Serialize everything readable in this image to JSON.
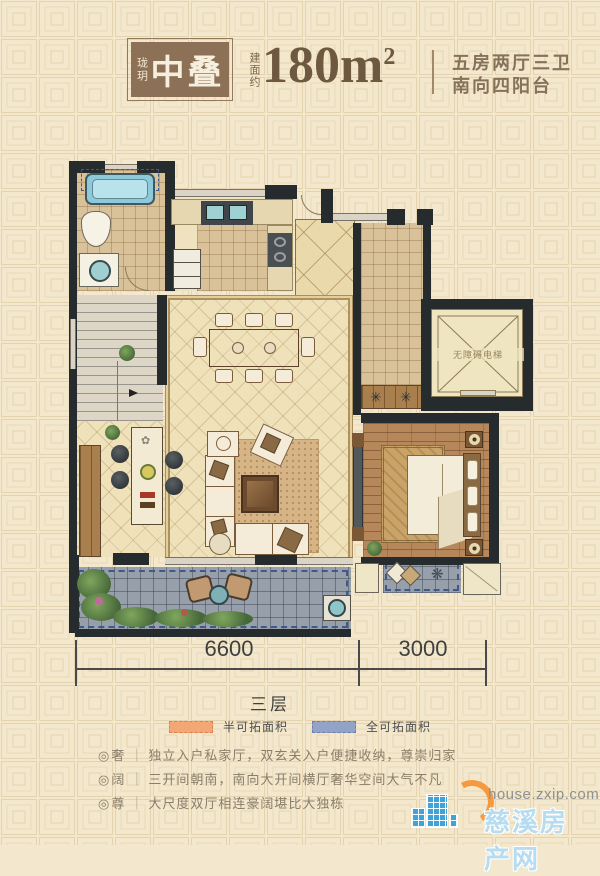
{
  "header": {
    "brand": "珑玥",
    "badge_title": "中叠",
    "area_prefix": "建面约",
    "area_value": "180m",
    "area_sup": "2",
    "spec_line1": "五房两厅三卫",
    "spec_line2": "南向四阳台"
  },
  "plan": {
    "elevator_label": "无障碍电梯",
    "icons": {
      "pinwheel": "✳",
      "snowflake": "❋",
      "flower": "✿"
    }
  },
  "dimensions": {
    "left": "6600",
    "right": "3000",
    "floor": "三层"
  },
  "legend": [
    {
      "label": "半可拓面积",
      "color": "#f4a775"
    },
    {
      "label": "全可拓面积",
      "color": "#93a2c7"
    }
  ],
  "features": [
    {
      "bullet": "◎",
      "tag": "奢",
      "sep": "｜",
      "text": "独立入户私家厅，双玄关入户便捷收纳，尊崇归家"
    },
    {
      "bullet": "◎",
      "tag": "阔",
      "sep": "｜",
      "text": "三开间朝南，南向大开间横厅奢华空间大气不凡"
    },
    {
      "bullet": "◎",
      "tag": "尊",
      "sep": "｜",
      "text": "大尺度双厅相连豪阔堪比大独栋"
    }
  ],
  "watermark": {
    "url": "house.zxip.com",
    "site": "慈溪房产网"
  },
  "colors": {
    "accent_brown": "#8c7157",
    "legend_half": "#f4a775",
    "legend_full": "#93a2c7",
    "watermark_blue": "#3fa3d9",
    "watermark_orange": "#f59a40"
  }
}
